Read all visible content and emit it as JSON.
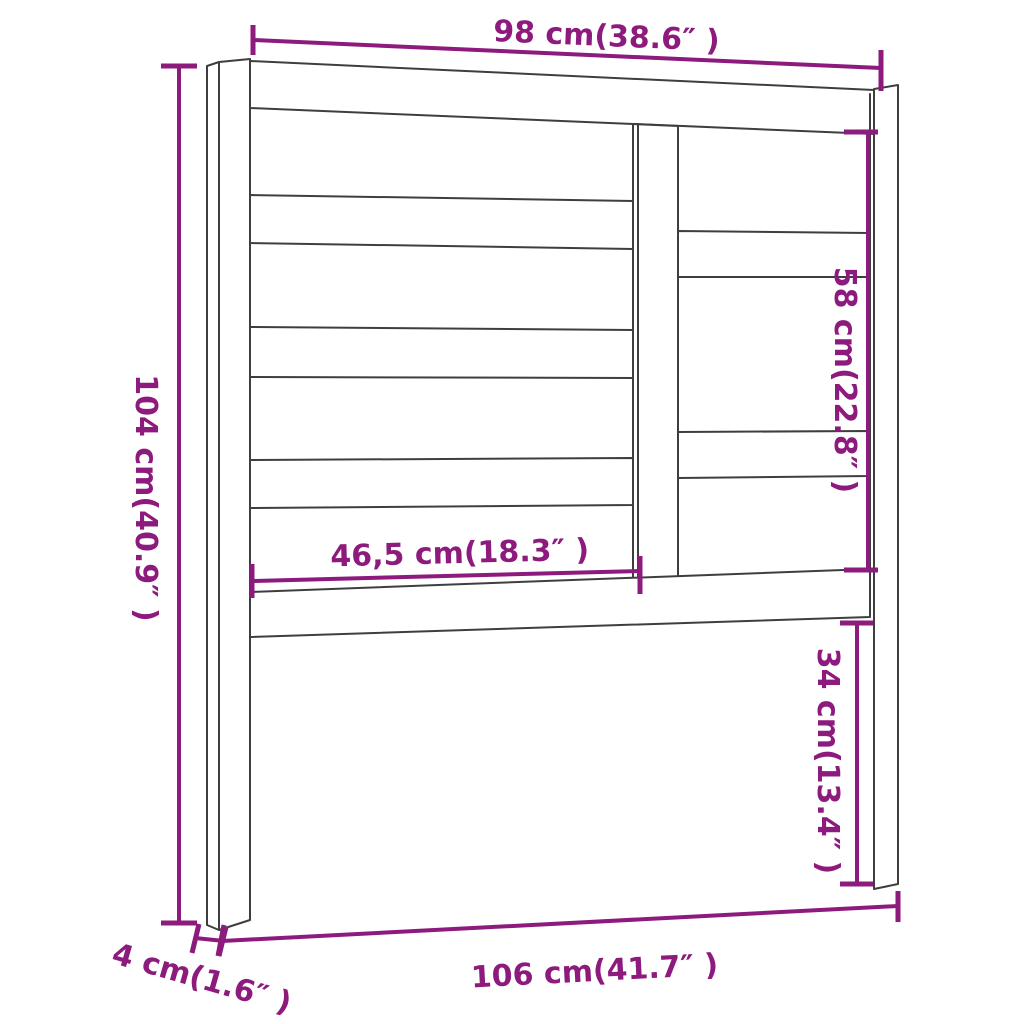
{
  "colors": {
    "accent": "#8d1a7d",
    "outline": "#3e3e3e",
    "background": "#ffffff"
  },
  "diagram": {
    "subject": "bed headboard technical dimension drawing",
    "dimensions": {
      "top_width": "98 cm(38.6″ )",
      "left_height": "104 cm(40.9″ )",
      "right_upper_height": "58 cm(22.8″ )",
      "inner_width": "46,5 cm(18.3″ )",
      "right_lower_height": "34 cm(13.4″ )",
      "bottom_width": "106 cm(41.7″ )",
      "leg_depth": "4 cm(1.6″ )"
    }
  }
}
